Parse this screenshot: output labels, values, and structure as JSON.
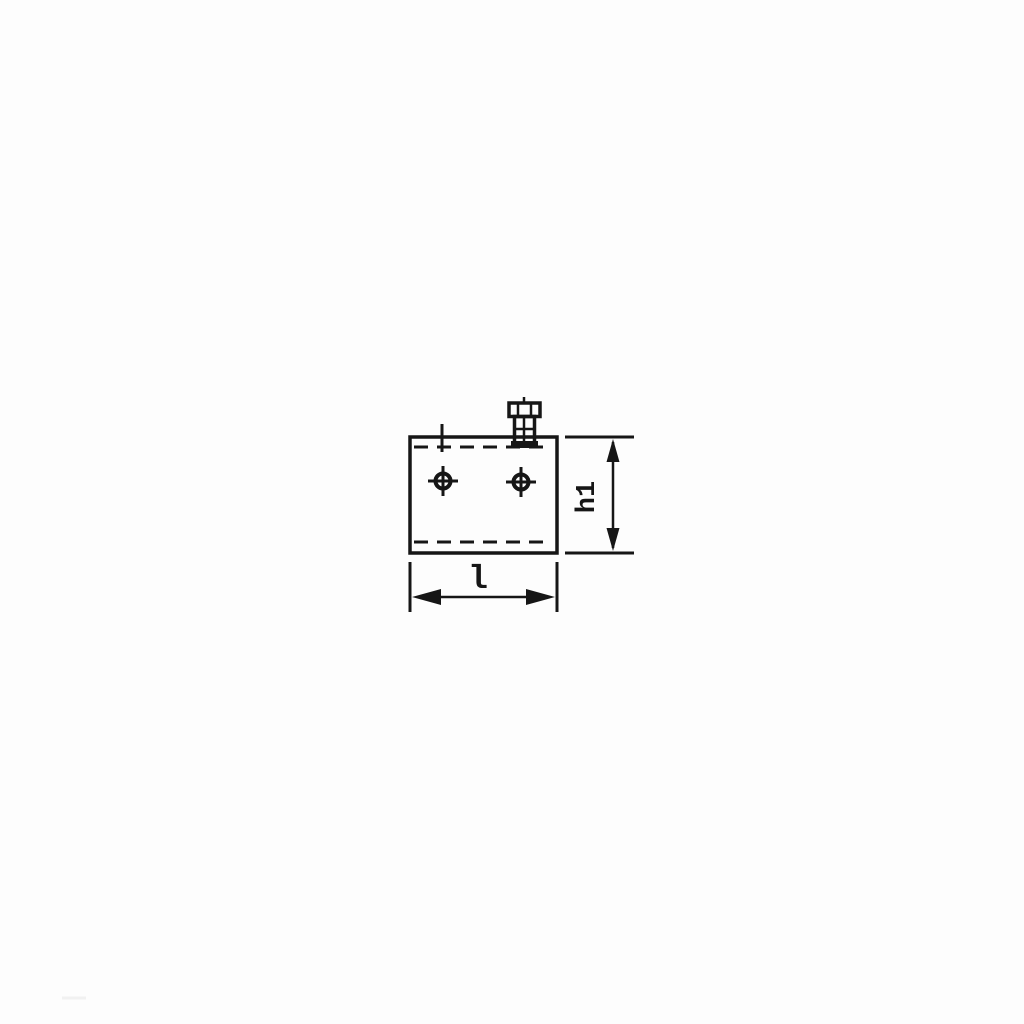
{
  "page": {
    "background_color": "#fdfdfd"
  },
  "drawing": {
    "ink_color": "#161616",
    "dimensions": {
      "height_label": "h1",
      "length_label": "l"
    }
  }
}
